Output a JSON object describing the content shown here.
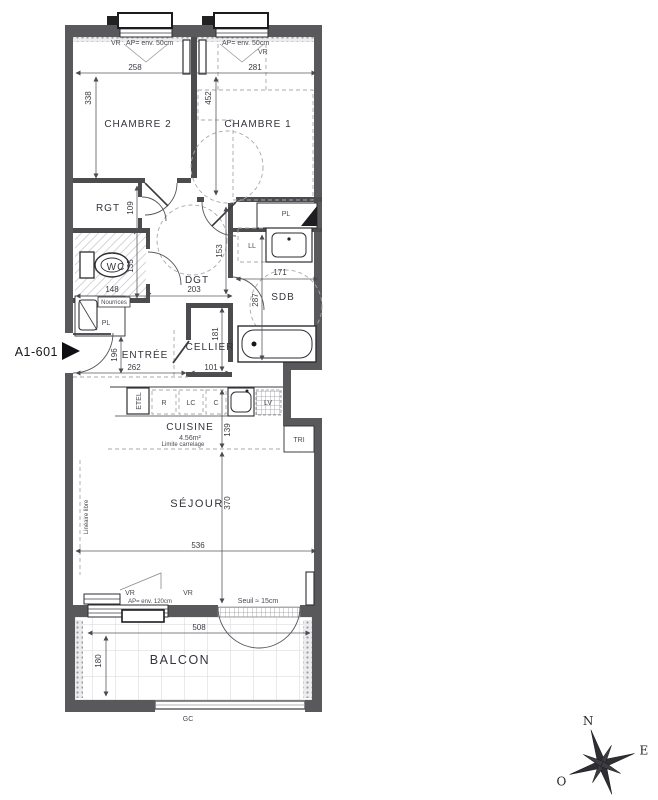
{
  "unit": {
    "label": "A1-601"
  },
  "rooms": {
    "chambre2": {
      "name": "CHAMBRE 2"
    },
    "chambre1": {
      "name": "CHAMBRE 1"
    },
    "rgt": {
      "name": "RGT"
    },
    "wc": {
      "name": "WC"
    },
    "dgt": {
      "name": "DGT"
    },
    "sdb": {
      "name": "SDB"
    },
    "entree": {
      "name": "ENTRÉE"
    },
    "cellier": {
      "name": "CELLIER"
    },
    "cuisine": {
      "name": "CUISINE",
      "area": "4.56m²"
    },
    "sejour": {
      "name": "SÉJOUR"
    },
    "balcon": {
      "name": "BALCON"
    },
    "tri": {
      "name": "TRI"
    }
  },
  "dims": {
    "chambre2_width": "258",
    "chambre1_width": "281",
    "chambre2_depth": "338",
    "chambre1_depth": "452",
    "rgt_depth": "109",
    "wc_depth": "135",
    "wc_width": "148",
    "dgt_width": "203",
    "dgt_depth": "153",
    "sdb_width": "171",
    "sdb_depth": "287",
    "entree_depth": "196",
    "entree_width": "262",
    "cellier_depth": "181",
    "cellier_width": "101",
    "cuisine_depth": "139",
    "sejour_depth": "370",
    "sejour_width": "536",
    "balcon_width": "508",
    "balcon_depth": "180"
  },
  "closets": {
    "pl_chambre1": "PL",
    "pl_entree": "PL",
    "ll": "LL",
    "nourrices": "Nourrices",
    "etel": "ETEL"
  },
  "kitchen_units": {
    "r": "R",
    "lc": "LC",
    "c": "C",
    "lv": "LV"
  },
  "annotations": {
    "vr1": "VR",
    "ap50_left": "AP= env. 50cm",
    "ap50_right": "AP= env. 50cm",
    "vr2": "VR",
    "vr3": "VR",
    "ap120": "AP= env. 120cm",
    "vr4": "VR",
    "seuil": "Seuil ≈ 15cm",
    "limite_carrelage": "Limite carrelage",
    "lineaire_libre": "Linéaire libre",
    "gc": "GC"
  },
  "compass": {
    "n": "N",
    "e": "E",
    "o": "O",
    "s": "S"
  }
}
